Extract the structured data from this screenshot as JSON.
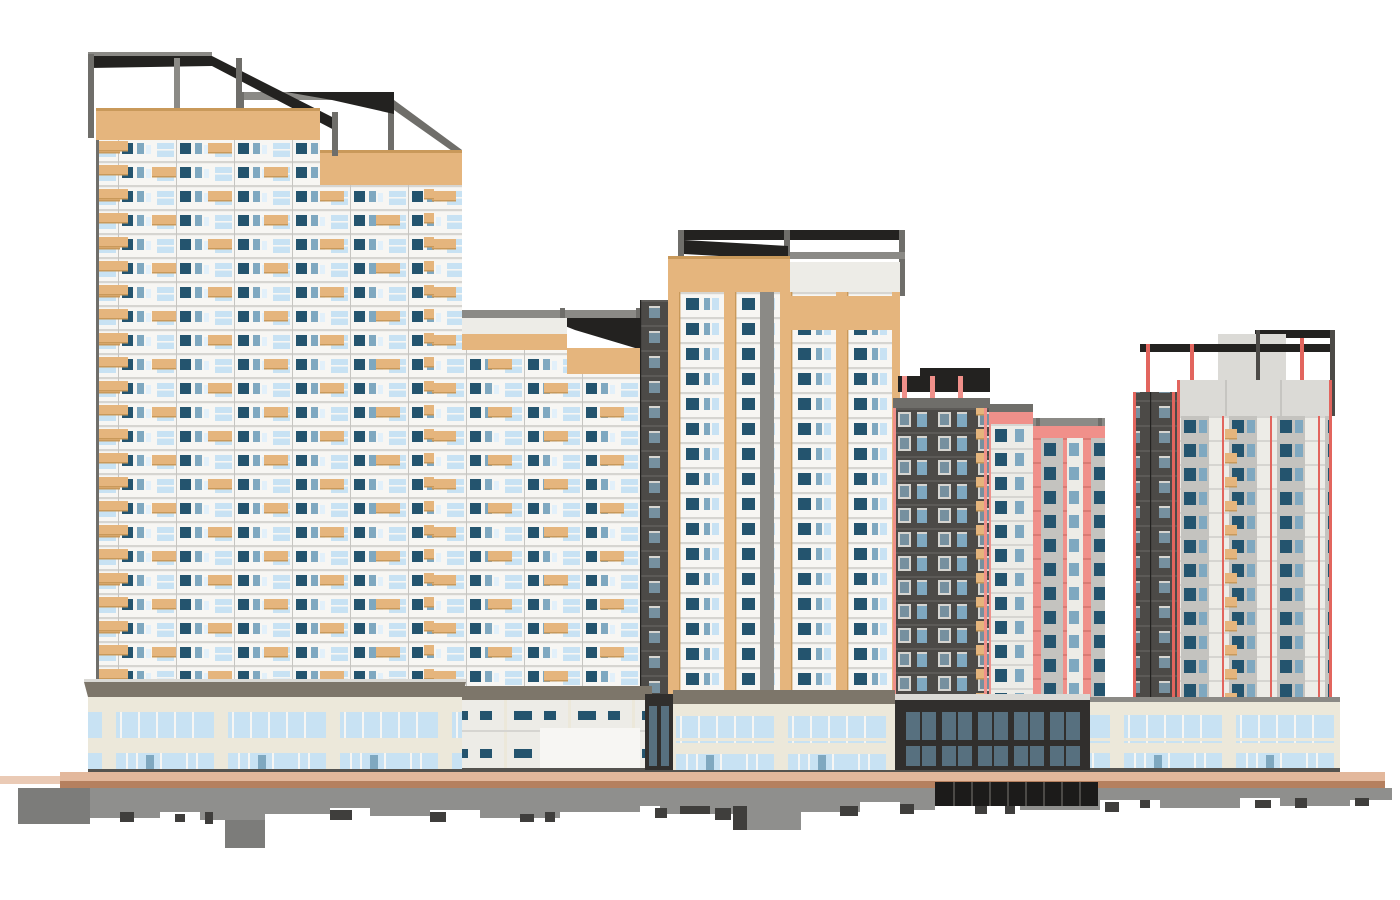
{
  "scene": {
    "kind": "bim-architectural-rendering",
    "subject": "high-rise-residential-complex-with-retail-podium-and-basement",
    "background": "#ffffff",
    "colors": {
      "background": "#ffffff",
      "facade_white": "#f7f6f3",
      "facade_offwhite": "#edece7",
      "slab_gray": "#d6d5d1",
      "mullion_gray": "#c6c5c1",
      "tan": "#e5b57d",
      "tan_dark": "#c9995a",
      "window_dark": "#24546e",
      "window_mid": "#7fa8c0",
      "glass_light": "#c8e2f3",
      "glass_pale": "#e2f0fa",
      "steel_gray": "#8b8a86",
      "steel_dark": "#6f6e6a",
      "steel_black": "#232220",
      "charcoal": "#4c4a47",
      "charcoal_light": "#5c5a57",
      "side_window": "#76909f",
      "salmon": "#f0908a",
      "salmon_dark": "#d97b74",
      "red_stripe": "#e2655e",
      "gray_panel": "#c4c3bf",
      "light_band": "#dbdad6",
      "podium_cream": "#ece8da",
      "podium_cornice": "#7d766a",
      "podium_dark": "#312f2d",
      "podium_dark_glass": "#57707f",
      "sidewalk_light": "#e3b89c",
      "sidewalk_dark": "#b5805f",
      "basement_gray": "#8f8f8d",
      "basement_step": "#7c7c7a",
      "basement_notch": "#3f3e3c",
      "garage_black": "#1c1b1a",
      "base_line": "#55534f"
    },
    "buildings": [
      {
        "id": "tower-1",
        "position": "far-left",
        "style": "white-facade-tan-accents",
        "floors": 24,
        "roof": "dark-steel-frame"
      },
      {
        "id": "tower-2",
        "position": "left",
        "style": "white-facade-tan-accents",
        "floors": 21,
        "roof": "dark-steel-frame"
      },
      {
        "id": "tower-3",
        "position": "center-left",
        "style": "white-facade-tan-accents",
        "floors": 15,
        "roof": "steel-frame"
      },
      {
        "id": "tower-4",
        "position": "center",
        "style": "white-facade-tan-stripes-charcoal-side",
        "floors": 17,
        "roof": "dark-steel-frame"
      },
      {
        "id": "tower-5",
        "position": "center-right",
        "style": "charcoal-and-salmon-panels",
        "floors": 13,
        "roof": "dark-frame-red-posts"
      },
      {
        "id": "tower-6",
        "position": "far-right",
        "style": "gray-panels-red-stripes-charcoal-side",
        "floors": 13,
        "roof": "dark-frame-red-posts"
      }
    ],
    "ground": {
      "podium_levels": 2,
      "podium_type": "glazed-storefront",
      "dark_podium": "glazed-charcoal-pavilion",
      "sidewalk": "two-tone-paving",
      "basement": "exposed-gray-substructure-with-jagged-cut"
    }
  }
}
